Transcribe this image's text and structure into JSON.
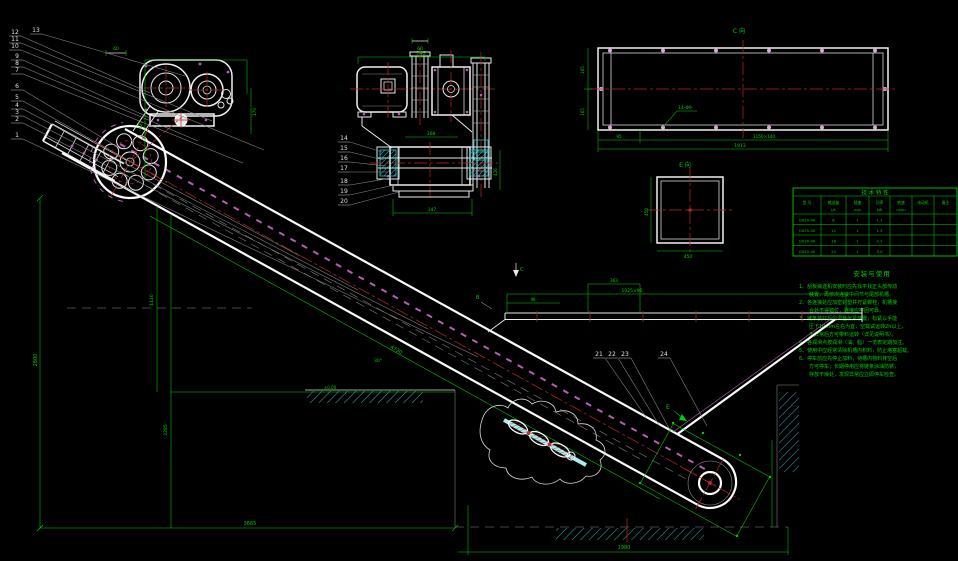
{
  "balloons": {
    "left": [
      "13",
      "12",
      "11",
      "10",
      "9",
      "8",
      "7",
      "6",
      "5",
      "4",
      "3",
      "2",
      "1"
    ],
    "drive": [
      "14",
      "15",
      "16",
      "17",
      "18",
      "19",
      "20"
    ],
    "hopper": [
      "21",
      "22",
      "23",
      "24"
    ]
  },
  "marks": {
    "c_arrow": "C",
    "b_arrow": "B",
    "e_arrow": "E"
  },
  "dims": {
    "head_small": "40",
    "head_box": "420",
    "head_right": "170",
    "motor_top": "60",
    "motor_width": "745",
    "shaft_span": "308",
    "base_width": "147",
    "drive_height": "426",
    "hopper_small": "363",
    "hopper_len": "1025×90",
    "hopper_left": "98",
    "left_height": "2800",
    "mid_h1": "1120",
    "mid_h2": "2285",
    "bottom_left": "3665",
    "bottom_right": "1980",
    "ground": "±0.00",
    "angle": "30°",
    "slope": "4730"
  },
  "view_c": {
    "label": "C向",
    "callout": "14-Φ9",
    "left_top": "165",
    "left_bot": "165",
    "b_small": "95",
    "b_mid": "1150×140",
    "b_total": "1913"
  },
  "view_e": {
    "label": "E向",
    "w": "450",
    "h": "450"
  },
  "table": {
    "title": "技 术 特 性",
    "headers": [
      "型 号",
      "输送量",
      "链速",
      "功率",
      "转速",
      "电动机",
      "备注"
    ],
    "units": [
      "",
      "t/h",
      "m/s",
      "kW",
      "r/min",
      "",
      ""
    ],
    "rows": [
      [
        "GX20-40",
        "8",
        "1",
        "1.1",
        "",
        "",
        ""
      ],
      [
        "GX25-40",
        "12",
        "1",
        "1.5",
        "",
        "",
        ""
      ],
      [
        "GX30-40",
        "16",
        "1",
        "2.2",
        "",
        "",
        ""
      ],
      [
        "GX40-40",
        "24",
        "1",
        "3.0",
        "",
        "",
        ""
      ]
    ]
  },
  "notes": {
    "title": "安装与使用",
    "lines": [
      "1、刮板输送机安装时应先找平找正头部传动",
      "　　装置，再依次连接中间节与尾部机槽。",
      "2、各连接处应加密封垫并拧紧螺栓，机槽接",
      "　　合处不得错位，连接应牢固可靠。",
      "3、链条装好后应调整张紧装置，松紧以手能",
      "　　压下10mm左右为宜，空载试运转2h以上，",
      "　　无异常后方可带料运转（详见说明书）。",
      "4、各润滑点按润滑（油、脂）一览表定期加注。",
      "5、使用中应经常清除机槽内积料，防止堵塞超载。",
      "6、停车前应先停止加料，待槽内物料排空后",
      "　　方可停车；长期停用应将链条涂油防锈，",
      "　　存放干燥处，发现异常应立即停车检查。"
    ]
  }
}
